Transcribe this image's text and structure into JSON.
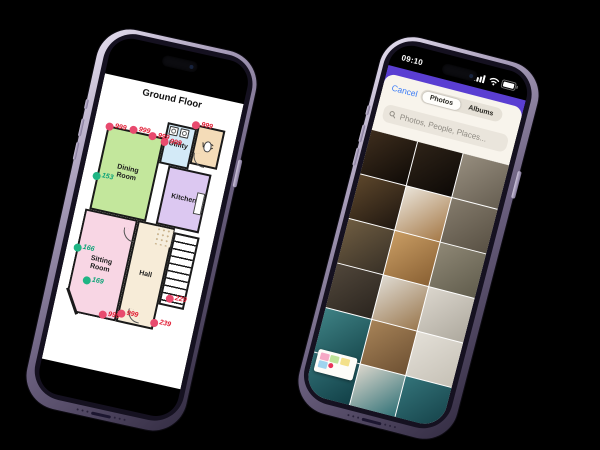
{
  "scene": {
    "background_color": "#000000"
  },
  "left_phone": {
    "floorplan": {
      "title": "Ground Floor",
      "wall_color": "#1a1a1a",
      "palette": {
        "red_dot": "#e84a6e",
        "red_label": "#e01931",
        "green_dot": "#1fb584",
        "green_label": "#0da377"
      },
      "rooms": [
        {
          "id": "utility",
          "label": "Utility",
          "color": "#d3eaf7",
          "x": 72,
          "y": 34,
          "w": 30,
          "h": 42
        },
        {
          "id": "wc",
          "label": "WC",
          "color": "#f4dcb8",
          "x": 102,
          "y": 30,
          "w": 28,
          "h": 40
        },
        {
          "id": "kitchen",
          "label": "Kitchen",
          "color": "#dcc8f1",
          "x": 82,
          "y": 76,
          "w": 44,
          "h": 60
        },
        {
          "id": "dining-room",
          "label": "Dining Room",
          "color": "#c3e79c",
          "x": 14,
          "y": 50,
          "w": 58,
          "h": 86
        },
        {
          "id": "sitting-room",
          "label": "Sitting Room",
          "color": "#f8d6e4",
          "x": 10,
          "y": 136,
          "w": 54,
          "h": 104
        },
        {
          "id": "hall",
          "label": "Hall",
          "color": "#f7ecd8",
          "x": 64,
          "y": 136,
          "w": 38,
          "h": 104
        }
      ],
      "markers": [
        {
          "x": 100,
          "y": 31,
          "color": "red",
          "label": "999"
        },
        {
          "x": 73,
          "y": 54,
          "color": "red",
          "label": "999"
        },
        {
          "x": 16,
          "y": 51,
          "color": "red",
          "label": "999"
        },
        {
          "x": 40,
          "y": 49,
          "color": "red",
          "label": "999"
        },
        {
          "x": 60,
          "y": 51,
          "color": "red",
          "label": "999"
        },
        {
          "x": 14,
          "y": 102,
          "color": "green",
          "label": "153"
        },
        {
          "x": 11,
          "y": 176,
          "color": "green",
          "label": "166"
        },
        {
          "x": 27,
          "y": 206,
          "color": "green",
          "label": "169"
        },
        {
          "x": 50,
          "y": 236,
          "color": "red",
          "label": "999"
        },
        {
          "x": 68,
          "y": 231,
          "color": "red",
          "label": "999"
        },
        {
          "x": 112,
          "y": 206,
          "color": "red",
          "label": "229"
        },
        {
          "x": 102,
          "y": 233,
          "color": "red",
          "label": "239"
        }
      ]
    }
  },
  "right_phone": {
    "status_bar": {
      "time": "09:10"
    },
    "nav_accent_color": "#5a3ed2",
    "search_panel": {
      "cancel_label": "Cancel",
      "tabs": [
        {
          "label": "Photos",
          "selected": true
        },
        {
          "label": "Albums",
          "selected": false
        }
      ],
      "search_placeholder": "Photos, People, Places...",
      "link_color": "#3a7bf7"
    },
    "photo_grid": {
      "columns": 3,
      "tiles": [
        {
          "id": "attic-rafters-dark",
          "c1": "#3d2d1d",
          "c2": "#100b07"
        },
        {
          "id": "attic-rafters-pipe",
          "c1": "#2e2318",
          "c2": "#0d0906"
        },
        {
          "id": "attic-insulation-gray",
          "c1": "#968d7e",
          "c2": "#675f52"
        },
        {
          "id": "attic-beams-angled",
          "c1": "#5c462b",
          "c2": "#201710"
        },
        {
          "id": "loft-eaves-room",
          "c1": "#e9e3d8",
          "c2": "#a67a49"
        },
        {
          "id": "attic-insulation-brown",
          "c1": "#837a6b",
          "c2": "#595144"
        },
        {
          "id": "loft-boards-person",
          "c1": "#6e5c41",
          "c2": "#393127"
        },
        {
          "id": "wood-floorboards",
          "c1": "#c89c63",
          "c2": "#8a6134"
        },
        {
          "id": "insulation-person-crouching",
          "c1": "#8e8775",
          "c2": "#615d4d"
        },
        {
          "id": "person-on-boards",
          "c1": "#50463a",
          "c2": "#2b251f"
        },
        {
          "id": "stairs-white-cupboard",
          "c1": "#ded9d0",
          "c2": "#9b7950"
        },
        {
          "id": "white-wall-pipe",
          "c1": "#dad5cc",
          "c2": "#aea99e"
        },
        {
          "id": "teal-stairs-person-top",
          "c1": "#3e8184",
          "c2": "#194b50"
        },
        {
          "id": "brown-carpet-stairs-down",
          "c1": "#a68257",
          "c2": "#6e5133"
        },
        {
          "id": "white-ceiling-corner",
          "c1": "#e3dfd7",
          "c2": "#c6c1b6"
        },
        {
          "id": "teal-landing-window",
          "c1": "#317076",
          "c2": "#113f46"
        },
        {
          "id": "teal-stairs-hallway",
          "c1": "#d9d5cb",
          "c2": "#2d6f75"
        },
        {
          "id": "teal-stairs-person",
          "c1": "#337379",
          "c2": "#144047"
        }
      ]
    },
    "floorplan_thumbnail": {
      "block_colors": [
        "#f6a9c6",
        "#bfe49a",
        "#f3e08a",
        "#9fd4ef",
        "#e8335a"
      ]
    }
  }
}
